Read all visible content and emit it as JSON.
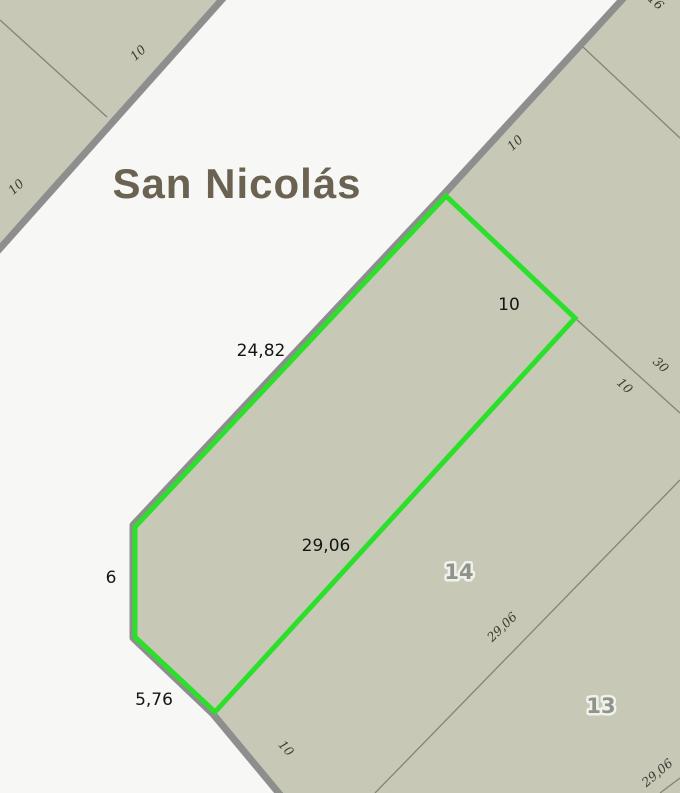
{
  "map": {
    "street": {
      "name": "San Nicolás"
    },
    "selected_parcel": {
      "frontage_road": "24,82",
      "side_ne": "10",
      "side_se": "29,06",
      "side_west": "6",
      "side_sw": "5,76"
    },
    "parcel_numbers": {
      "lot_14": "14",
      "lot_13": "13"
    },
    "edge_labels": {
      "nw_block_upper": "10",
      "nw_block_lower": "10",
      "top_right_partial": "16",
      "top_right_road_frontage": "10",
      "depth_30": "30",
      "depth_10": "10",
      "boundary_29_06_mid": "29,06",
      "boundary_29_06_corner": "29,06",
      "bottom_road_frontage": "10"
    },
    "colors": {
      "road_background": "#f7f7f5",
      "parcel_fill": "#c7c9b6",
      "road_casing": "#8e8e8e",
      "boundary_line": "#83837a",
      "highlight_green": "#2bdf2b",
      "dimension_text": "#151515",
      "edge_text": "#3b3b33",
      "parcel_number_text": "#8f948a",
      "street_text": "#6b6252"
    }
  }
}
